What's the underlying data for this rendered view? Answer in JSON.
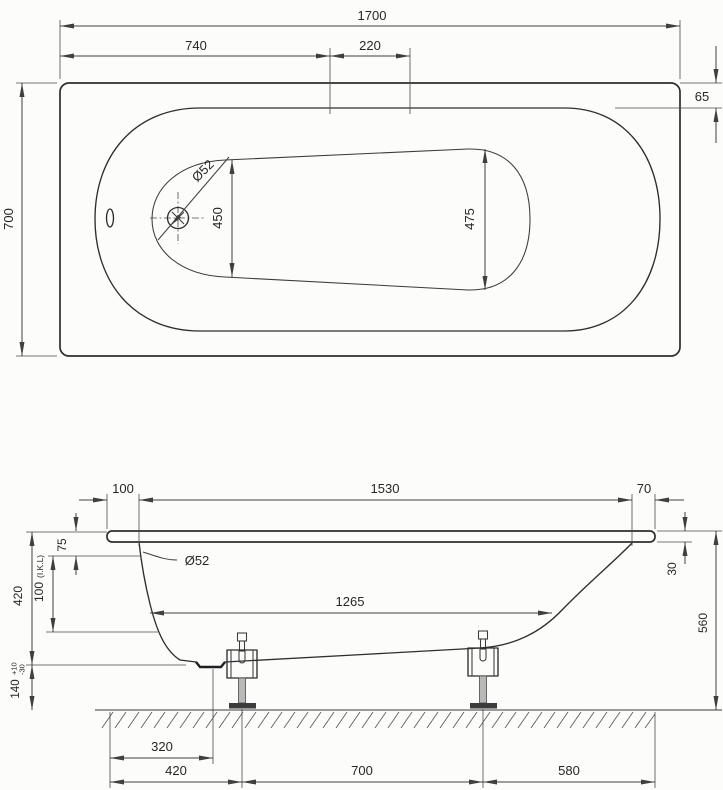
{
  "top_view": {
    "length_total": "1700",
    "tap_offset": "740",
    "tap_spacing": "220",
    "width_total": "700",
    "rim_width": "65",
    "floor_width_drain_end": "450",
    "floor_width_foot_end": "475",
    "drain_diameter": "Ø52"
  },
  "side_view": {
    "rim_left_overhang": "100",
    "rim_opening_length": "1530",
    "rim_right_overhang": "70",
    "rim_to_overflow": "75",
    "overflow_dim_value": "100",
    "overflow_dim_note": "(I.K.L)",
    "tub_depth": "420",
    "leg_height": "140",
    "leg_height_tol_plus": "+10",
    "leg_height_tol_minus": "-30",
    "overflow_diameter": "Ø52",
    "floor_inner_length": "1265",
    "rim_thickness": "30",
    "height_total": "560",
    "drain_offset": "320",
    "leg1_offset": "420",
    "leg_spacing": "700",
    "leg2_to_edge": "580"
  }
}
